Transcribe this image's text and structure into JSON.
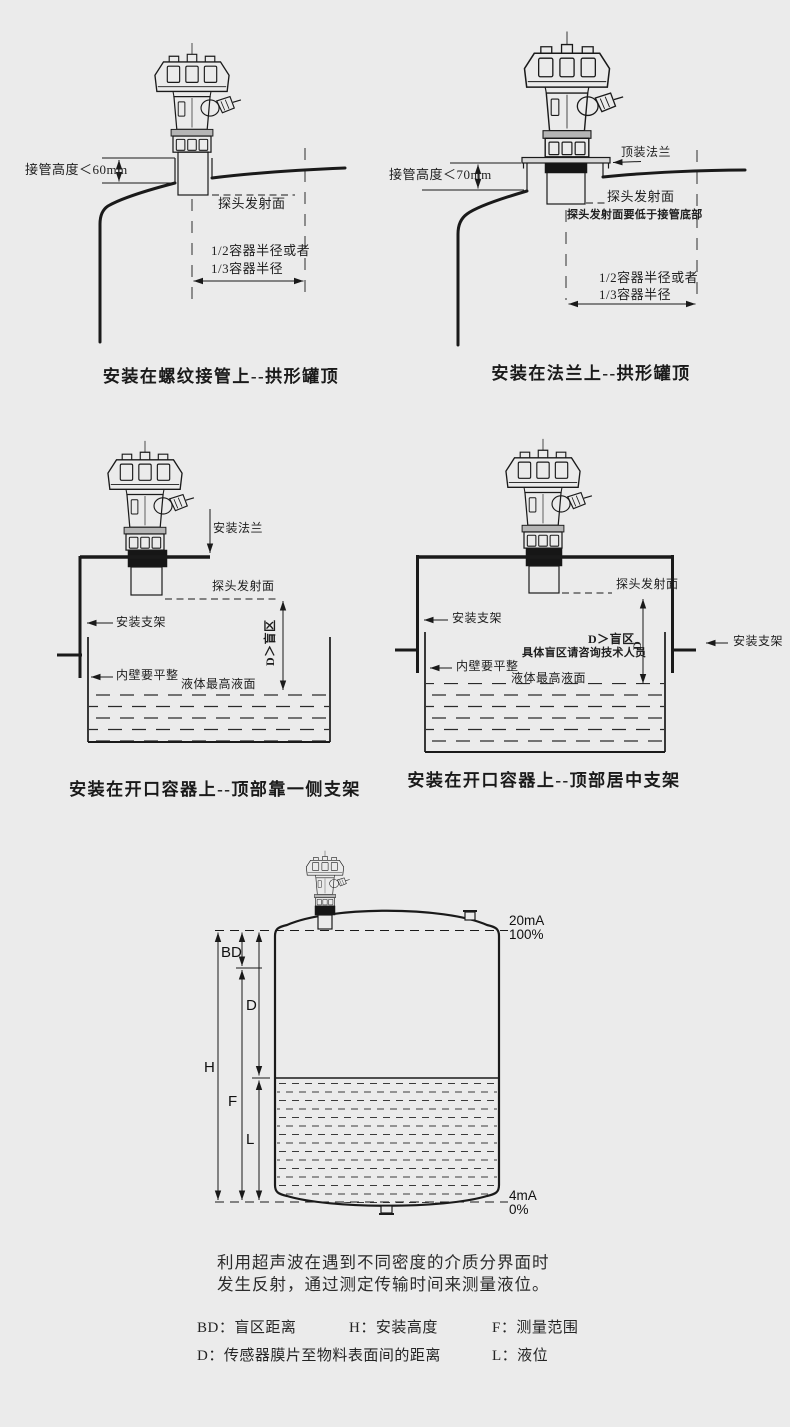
{
  "colors": {
    "background": "#ebebeb",
    "line": "#1a1a1a",
    "thread_band": "#161616",
    "collar": "#b5b5b5"
  },
  "diagram1": {
    "caption": "安装在螺纹接管上--拱形罐顶",
    "labels": {
      "pipe_height": "接管高度＜60mm",
      "probe_face": "探头发射面",
      "radius1": "1/2容器半径或者",
      "radius2": "1/3容器半径"
    }
  },
  "diagram2": {
    "caption": "安装在法兰上--拱形罐顶",
    "labels": {
      "top_flange": "顶装法兰",
      "pipe_height": "接管高度＜70mm",
      "probe_face": "探头发射面",
      "probe_note": "探头发射面要低于接管底部",
      "radius1": "1/2容器半径或者",
      "radius2": "1/3容器半径"
    }
  },
  "diagram3": {
    "caption": "安装在开口容器上--顶部靠一侧支架",
    "labels": {
      "mount_flange": "安装法兰",
      "probe_face": "探头发射面",
      "bracket": "安装支架",
      "blind_zone": "D＞盲区",
      "inner_wall": "内壁要平整",
      "max_level": "液体最高液面"
    }
  },
  "diagram4": {
    "caption": "安装在开口容器上--顶部居中支架",
    "labels": {
      "probe_face": "探头发射面",
      "bracket_left": "安装支架",
      "bracket_right": "安装支架",
      "blind_zone": "D＞盲区",
      "dim_d": "D",
      "blind_note": "具体盲区请咨询技术人员",
      "inner_wall": "内壁要平整",
      "max_level": "液体最高液面"
    }
  },
  "diagram5": {
    "dims": {
      "bd": "BD",
      "d": "D",
      "h": "H",
      "f": "F",
      "l": "L"
    },
    "outputs": {
      "top_ma": "20mA",
      "top_pct": "100%",
      "bottom_ma": "4mA",
      "bottom_pct": "0%"
    }
  },
  "description": {
    "line1": "利用超声波在遇到不同密度的介质分界面时",
    "line2": "发生反射，通过测定传输时间来测量液位。"
  },
  "legend": {
    "items": [
      {
        "k": "BD：",
        "v": "盲区距离"
      },
      {
        "k": "H：",
        "v": "安装高度"
      },
      {
        "k": "F：",
        "v": "测量范围"
      },
      {
        "k": "D：",
        "v": "传感器膜片至物料表面间的距离"
      },
      {
        "k": "L：",
        "v": "液位"
      }
    ]
  }
}
